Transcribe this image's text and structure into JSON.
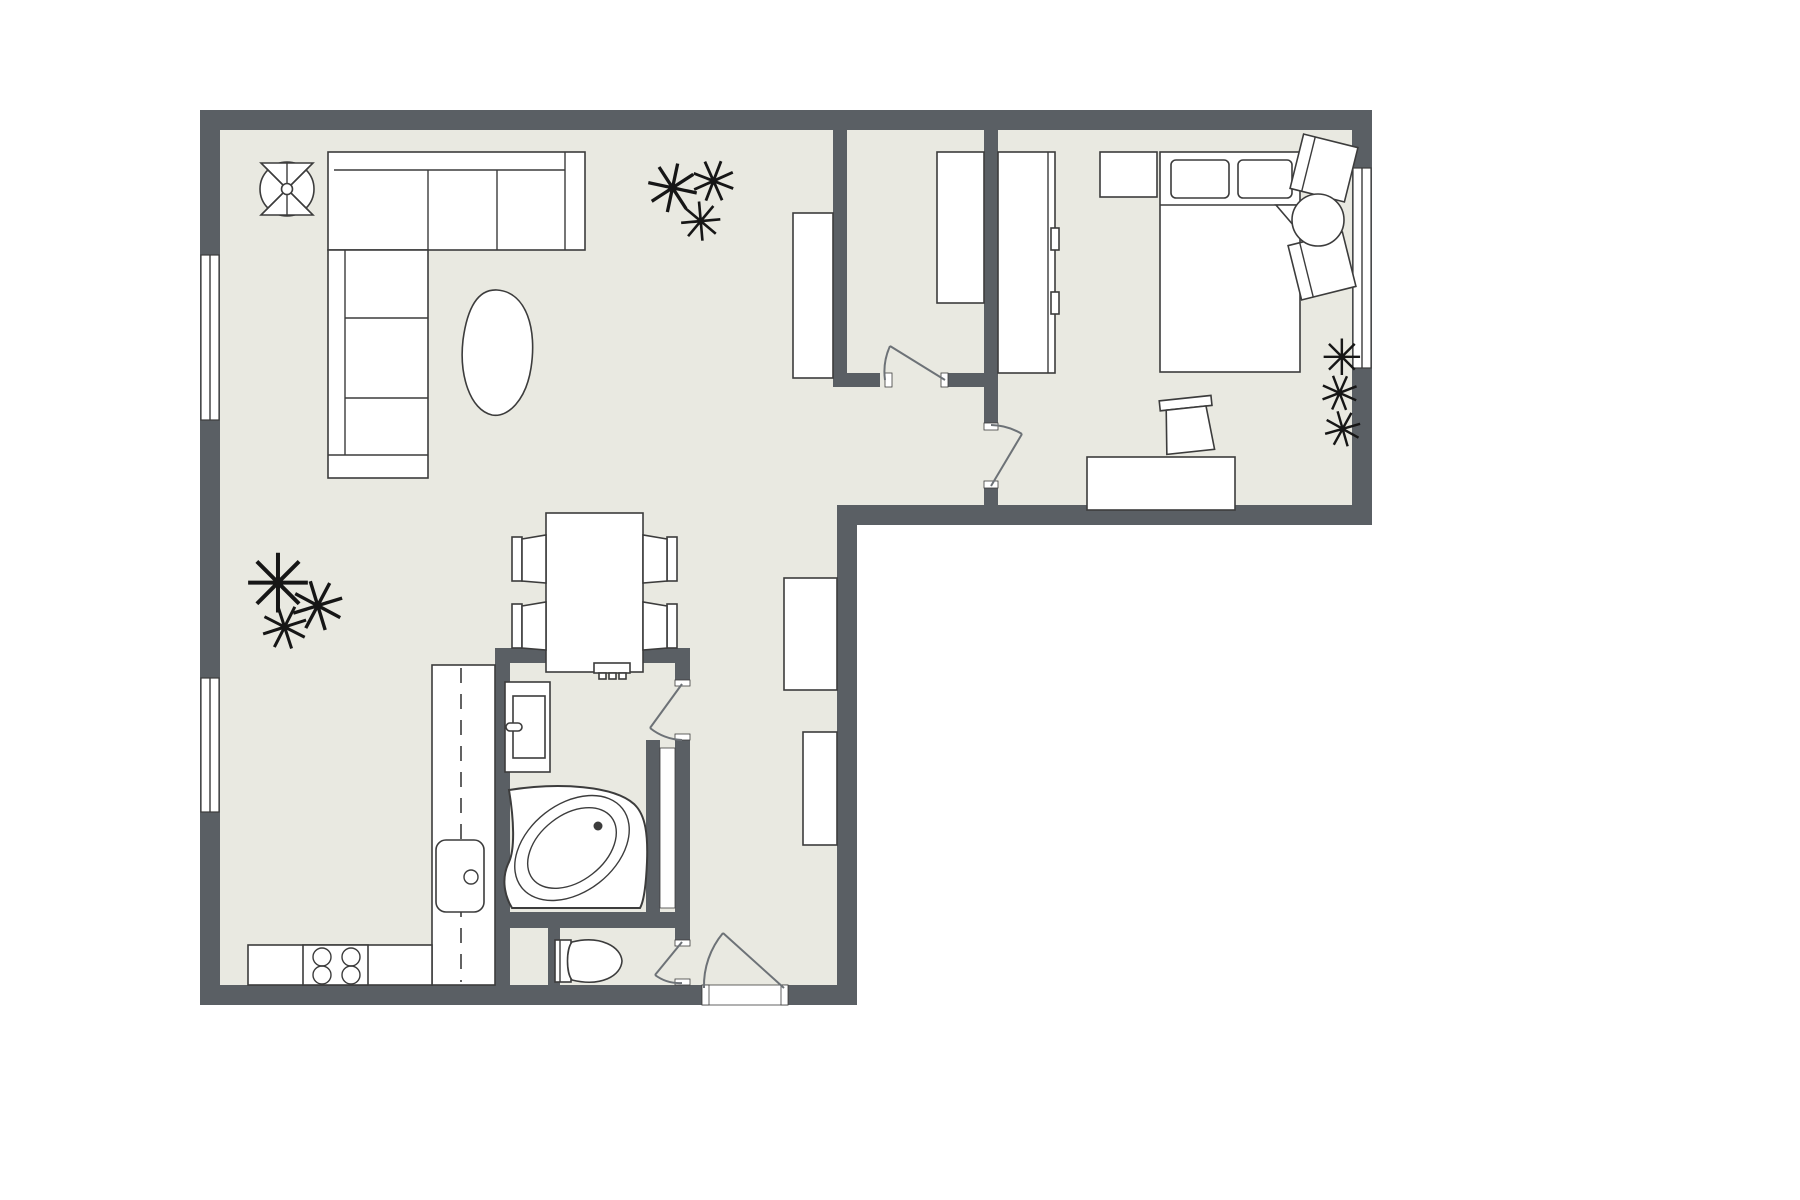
{
  "document": {
    "kind": "floor-plan",
    "text_labels": []
  },
  "colors": {
    "wall": "#5a5f64",
    "floor": "#e9e9e1",
    "outline": "#3c3c3c",
    "furniture": "#ffffff",
    "plant": "#161616",
    "door": "#6d7277",
    "background": "#ffffff"
  },
  "labels": {
    "plan": "apartment floor plan",
    "living": "living room area",
    "dining": "dining area",
    "kitchen": "kitchen area",
    "bathroom": "bathroom",
    "wc": "toilet room",
    "hall": "entry hall",
    "closet_room": "walk-in closet room",
    "bedroom": "bedroom",
    "nook": "sitting nook"
  },
  "inventory": {
    "living": [
      "ceiling-fan",
      "sectional-sofa",
      "coffee-table",
      "floor-plant",
      "palm-plant",
      "sideboard"
    ],
    "dining": [
      "dining-table",
      "dining-chair x4"
    ],
    "kitchen": [
      "counter-run-vertical",
      "counter-run-bottom",
      "kitchen-sink",
      "cooktop-4-burners"
    ],
    "bathroom": [
      "washing-machine-cabinet",
      "towel-radiator",
      "corner-bathtub",
      "duct-niche"
    ],
    "wc": [
      "toilet"
    ],
    "hall": [
      "hall-cabinet-large",
      "hall-cabinet-small",
      "entry-door"
    ],
    "closet_room": [
      "wardrobe"
    ],
    "bedroom": [
      "wardrobe-sliding",
      "nightstand",
      "double-bed",
      "pillow x2",
      "blanket-fold",
      "desk",
      "desk-chair"
    ],
    "nook": [
      "armchair x2",
      "round-side-table",
      "window-planter-plants"
    ],
    "windows": [
      "left-window-upper",
      "left-window-lower",
      "right-window"
    ],
    "doors": [
      "closet-room-door",
      "bedroom-door",
      "bathroom-door",
      "wc-door",
      "entry-door"
    ]
  },
  "plant_glyph": "✳"
}
